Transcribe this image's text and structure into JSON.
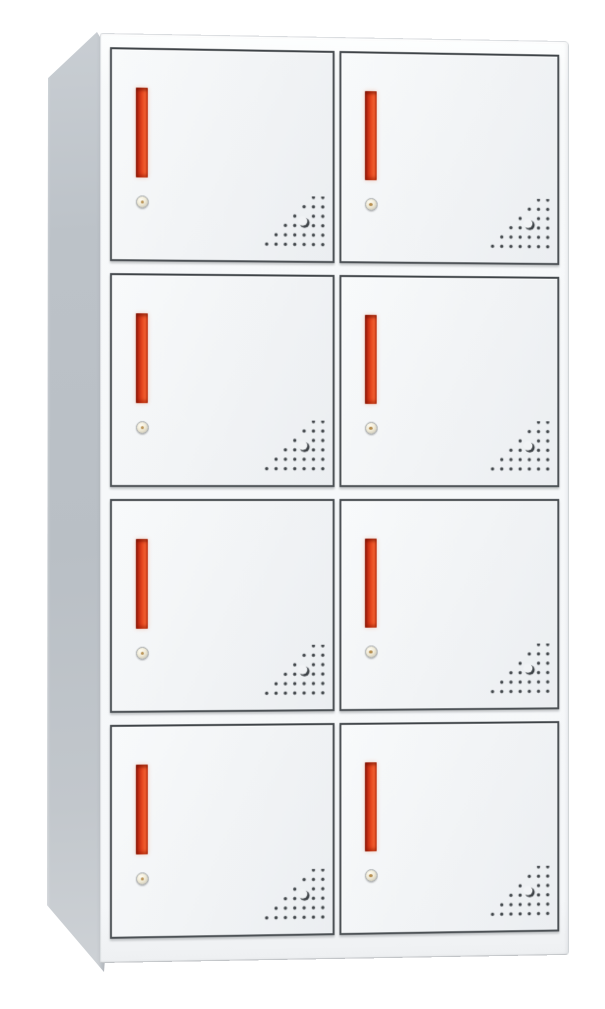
{
  "scene": {
    "type": "product-photo",
    "subject": "8-door metal locker storage cabinet",
    "background_color": "#ffffff"
  },
  "cabinet": {
    "rows": 4,
    "columns": 2,
    "door_count": 8,
    "colors": {
      "background": "#ffffff",
      "body_frame": "#f7f9fa",
      "door_face": "#f1f3f5",
      "door_border": "#4b5054",
      "side_panel": "#b9bfc5",
      "handle_red": "#e6461d",
      "handle_dark_red": "#8e1d0c",
      "lock_ring": "#b5b6b4",
      "lock_center": "#f1ecd9",
      "vent_dot": "#41464a"
    },
    "door_features": {
      "handle_icon": "vertical-recessed-pull-handle",
      "lock_icon": "round-cam-lock-keyhole",
      "vent_icon": "triangular-vent-holes"
    }
  },
  "doors": [
    {
      "id": "door-row1-left",
      "row": 1,
      "column": "left"
    },
    {
      "id": "door-row1-right",
      "row": 1,
      "column": "right"
    },
    {
      "id": "door-row2-left",
      "row": 2,
      "column": "left"
    },
    {
      "id": "door-row2-right",
      "row": 2,
      "column": "right"
    },
    {
      "id": "door-row3-left",
      "row": 3,
      "column": "left"
    },
    {
      "id": "door-row3-right",
      "row": 3,
      "column": "right"
    },
    {
      "id": "door-row4-left",
      "row": 4,
      "column": "left"
    },
    {
      "id": "door-row4-right",
      "row": 4,
      "column": "right"
    }
  ]
}
